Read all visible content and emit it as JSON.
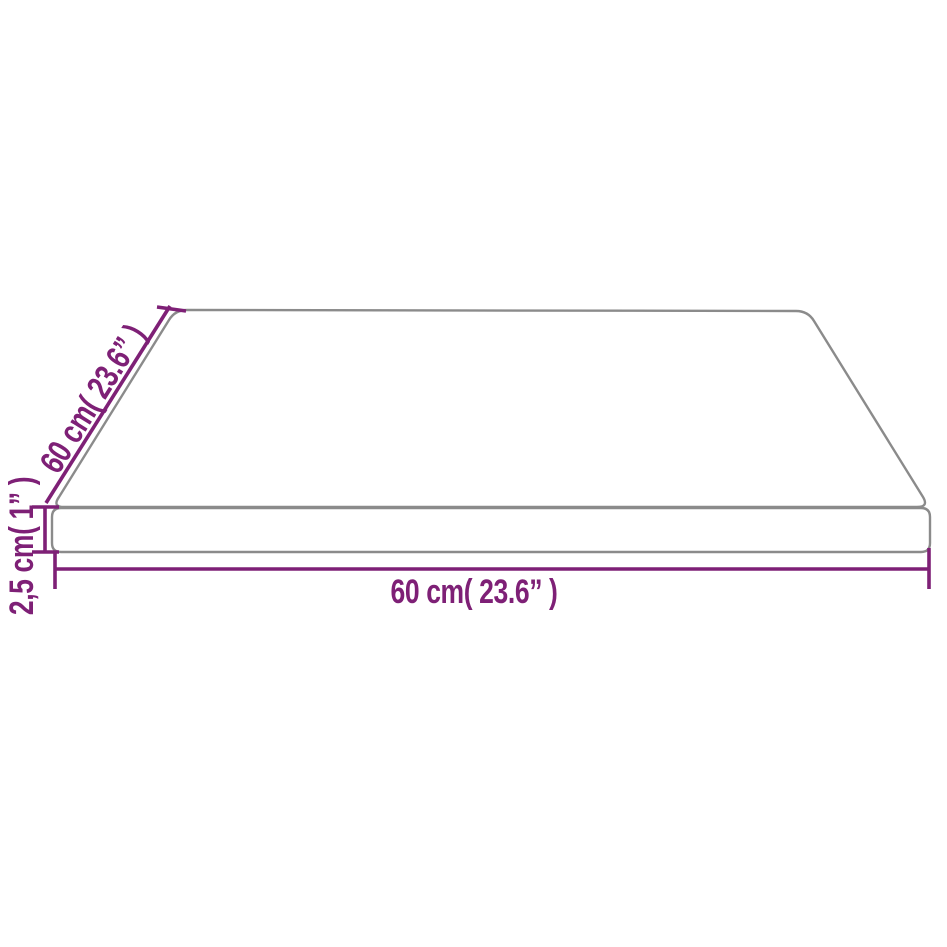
{
  "diagram": {
    "kind": "product-dimension-diagram",
    "subject": "rectangular table top panel shown in perspective",
    "background_color": "#ffffff",
    "outline_color": "#8b8b8b",
    "dimension_color": "#7e2076",
    "labels": {
      "width": "60 cm( 23.6” )",
      "depth": "60 cm( 23.6” )",
      "thickness": "2,5 cm( 1” )"
    },
    "values": {
      "width_cm": "60",
      "width_inch": "23.6",
      "depth_cm": "60",
      "depth_inch": "23.6",
      "thickness_cm": "2,5",
      "thickness_inch": "1"
    }
  }
}
